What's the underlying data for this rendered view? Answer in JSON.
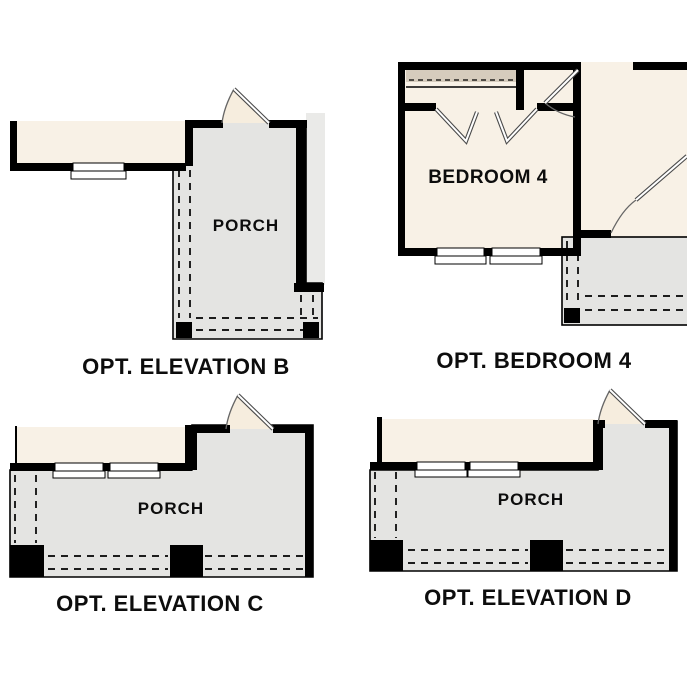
{
  "plans": [
    {
      "id": "opt-elevation-b",
      "title": "OPT. ELEVATION B",
      "room_label": "PORCH"
    },
    {
      "id": "opt-bedroom-4",
      "title": "OPT. BEDROOM 4",
      "room_label": "BEDROOM 4"
    },
    {
      "id": "opt-elevation-c",
      "title": "OPT. ELEVATION C",
      "room_label": "PORCH"
    },
    {
      "id": "opt-elevation-d",
      "title": "OPT. ELEVATION D",
      "room_label": "PORCH"
    }
  ],
  "colors": {
    "background": "#ffffff",
    "wall": "#000000",
    "room_fill": "#f8f1e6",
    "porch_fill": "#e4e4e2",
    "door_fan_fill": "#f6edde",
    "closet_fill": "#d6ccbd",
    "exterior_fill": "#eaeae8",
    "label_text": "#0d0d0d"
  }
}
